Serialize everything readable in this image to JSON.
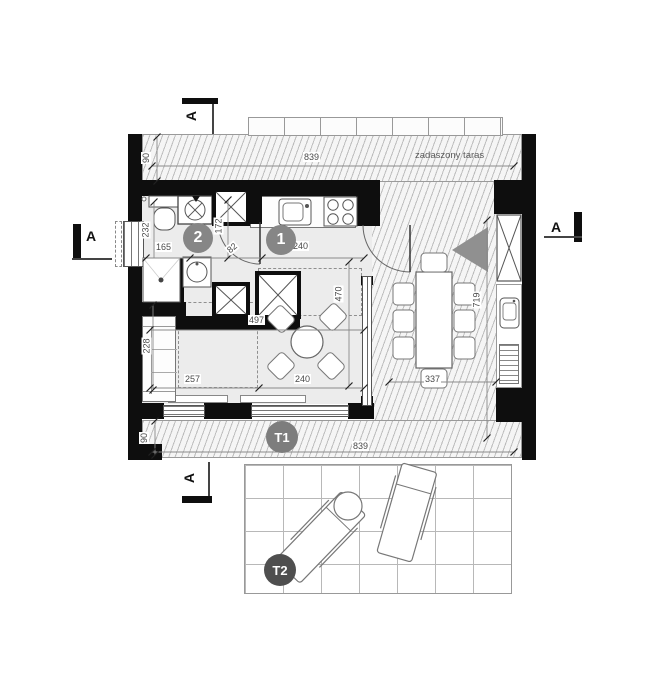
{
  "plan": {
    "rooms": {
      "kitchen_label": "1",
      "bath_label": "2"
    },
    "terraces": {
      "t1": "T1",
      "t2": "T2",
      "covered": "zadaszony taras"
    },
    "section_marker": "A",
    "dims": {
      "terrace_top_len": "839",
      "terrace_top_depth": "90",
      "bath_depth": "232",
      "bath_seg1": "165",
      "bath_seg2": "172",
      "door_w": "82",
      "kitchen_len": "240",
      "room_len": "497",
      "room_depth": "470",
      "seg_257": "257",
      "seg_240": "240",
      "sofa_len": "228",
      "terrace_right_len": "719",
      "dining_w": "337",
      "terrace_bottom_len": "839",
      "terrace_bottom_depth": "90"
    }
  }
}
